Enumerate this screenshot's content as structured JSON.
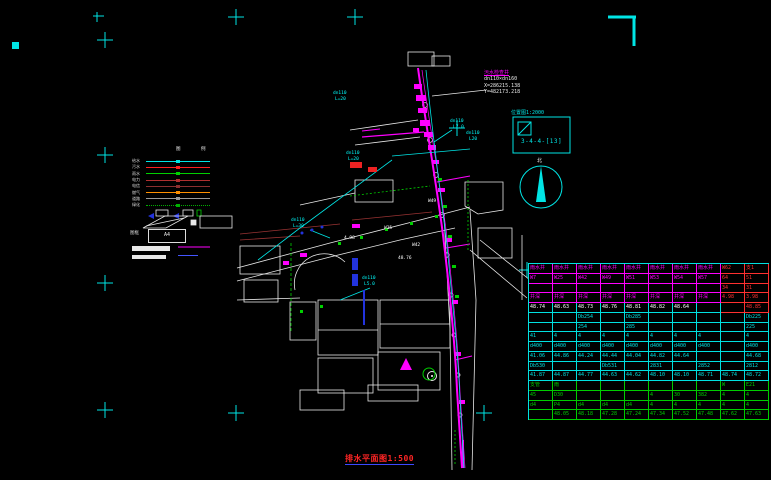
{
  "annotation": {
    "title": "污水检查井",
    "size_label": "dn110×dn160",
    "coord_x": "X=286215.138",
    "coord_y": "Y=482173.218"
  },
  "index_box": {
    "title": "位置图1:2000",
    "code": "3-4-4-[13]"
  },
  "north_label": "北",
  "legend": {
    "col_headers": [
      "图",
      "例"
    ],
    "items": [
      {
        "label": "给水",
        "color": "#00e5e5",
        "style": "solid"
      },
      {
        "label": "污水",
        "color": "#ff2020",
        "style": "solid"
      },
      {
        "label": "雨水",
        "color": "#00d000",
        "style": "solid"
      },
      {
        "label": "电力",
        "color": "#b03030",
        "style": "solid"
      },
      {
        "label": "电信",
        "color": "#8b2f2f",
        "style": "solid"
      },
      {
        "label": "燃气",
        "color": "#ff9000",
        "style": "solid"
      },
      {
        "label": "道路",
        "color": "#9a9a9a",
        "style": "solid"
      },
      {
        "label": "绿化",
        "color": "#00b000",
        "style": "dotted"
      }
    ],
    "frame_label": "图框",
    "a4_label": "A4"
  },
  "map": {
    "labels": [
      {
        "text": "dn110",
        "x": 450,
        "y": 119,
        "color": "#00ffff"
      },
      {
        "text": "L7.0",
        "x": 453,
        "y": 125,
        "color": "#00ffff"
      },
      {
        "text": "dn110",
        "x": 466,
        "y": 131,
        "color": "#00ffff"
      },
      {
        "text": "L20",
        "x": 469,
        "y": 137,
        "color": "#00ffff"
      },
      {
        "text": "dn110",
        "x": 291,
        "y": 218,
        "color": "#00ffff"
      },
      {
        "text": "L=30",
        "x": 293,
        "y": 224,
        "color": "#00ffff"
      },
      {
        "text": "dn110",
        "x": 362,
        "y": 276,
        "color": "#00ffff"
      },
      {
        "text": "L5.0",
        "x": 364,
        "y": 282,
        "color": "#00ffff"
      },
      {
        "text": "dn110",
        "x": 346,
        "y": 151,
        "color": "#00ffff"
      },
      {
        "text": "L=20",
        "x": 348,
        "y": 157,
        "color": "#00ffff"
      },
      {
        "text": "dn110",
        "x": 333,
        "y": 91,
        "color": "#00ffff"
      },
      {
        "text": "L=20",
        "x": 335,
        "y": 97,
        "color": "#00ffff"
      },
      {
        "text": "W25",
        "x": 384,
        "y": 226,
        "color": "#ffffff"
      },
      {
        "text": "W42",
        "x": 412,
        "y": 243,
        "color": "#ffffff"
      },
      {
        "text": "W49",
        "x": 428,
        "y": 199,
        "color": "#ffffff"
      },
      {
        "text": "4.98",
        "x": 344,
        "y": 236,
        "color": "#ffffff"
      },
      {
        "text": "48.76",
        "x": 398,
        "y": 256,
        "color": "#ffffff"
      }
    ]
  },
  "table": {
    "rows": [
      {
        "c": "m",
        "cells": [
          "雨水井",
          "雨水井",
          "雨水井",
          "雨水井",
          "雨水井",
          "雨水井",
          "雨水井",
          "雨水井",
          "W62",
          "支1"
        ]
      },
      {
        "c": "m",
        "cells": [
          "W7",
          "W25",
          "W42",
          "W49",
          "W51",
          "W53",
          "W54",
          "W57",
          "64",
          "51"
        ]
      },
      {
        "c": "m",
        "cells": [
          "",
          "",
          "",
          "",
          "",
          "",
          "",
          "",
          "34",
          "31"
        ]
      },
      {
        "c": "m",
        "cells": [
          "井深",
          "井深",
          "井深",
          "井深",
          "井深",
          "井深",
          "井深",
          "井深",
          "4.98",
          "3.98"
        ]
      },
      {
        "c": "w",
        "cells": [
          "48.74",
          "48.63",
          "48.73",
          "48.76",
          "48.81",
          "48.82",
          "48.64",
          "",
          "",
          "48.85"
        ]
      },
      {
        "c": "c",
        "cells": [
          "",
          "",
          "Db254",
          "",
          "Db285",
          "",
          "",
          "",
          "",
          "Db225"
        ]
      },
      {
        "c": "c",
        "cells": [
          "",
          "",
          "254",
          "",
          "285",
          "",
          "",
          "",
          "",
          "225"
        ]
      },
      {
        "c": "c",
        "cells": [
          "41",
          "4",
          "4",
          "4",
          "4",
          "4",
          "4",
          "4",
          "",
          "4"
        ]
      },
      {
        "c": "c",
        "cells": [
          "d400",
          "d400",
          "d400",
          "d400",
          "d400",
          "d400",
          "d400",
          "d400",
          "",
          "d400"
        ]
      },
      {
        "c": "c",
        "cells": [
          "41.06",
          "44.86",
          "44.24",
          "44.44",
          "44.04",
          "44.82",
          "44.64",
          "",
          "",
          "44.68"
        ]
      },
      {
        "c": "c",
        "cells": [
          "Db530",
          "",
          "",
          "Db531",
          "",
          "2831",
          "",
          "2852",
          "",
          "2812"
        ]
      },
      {
        "c": "c",
        "cells": [
          "41.87",
          "44.87",
          "44.77",
          "44.63",
          "44.62",
          "48.10",
          "48.10",
          "48.71",
          "48.74",
          "48.72"
        ]
      },
      {
        "c": "g",
        "cells": [
          "支管",
          "雨",
          "",
          "",
          "",
          "",
          "",
          "",
          "W",
          "E21"
        ]
      },
      {
        "c": "g",
        "cells": [
          "45",
          "D30",
          "",
          "",
          "",
          "4",
          "30",
          "382",
          "4",
          "4"
        ]
      },
      {
        "c": "g",
        "cells": [
          "d4",
          "P4",
          "d4",
          "d4",
          "d4",
          "4",
          "4",
          "4",
          "4",
          "4"
        ]
      },
      {
        "c": "g",
        "cells": [
          "",
          "48.05",
          "48.18",
          "47.28",
          "47.24",
          "47.34",
          "47.52",
          "47.48",
          "47.62",
          "47.63"
        ]
      }
    ]
  },
  "title_block": {
    "text": "排水平面图1:500"
  }
}
